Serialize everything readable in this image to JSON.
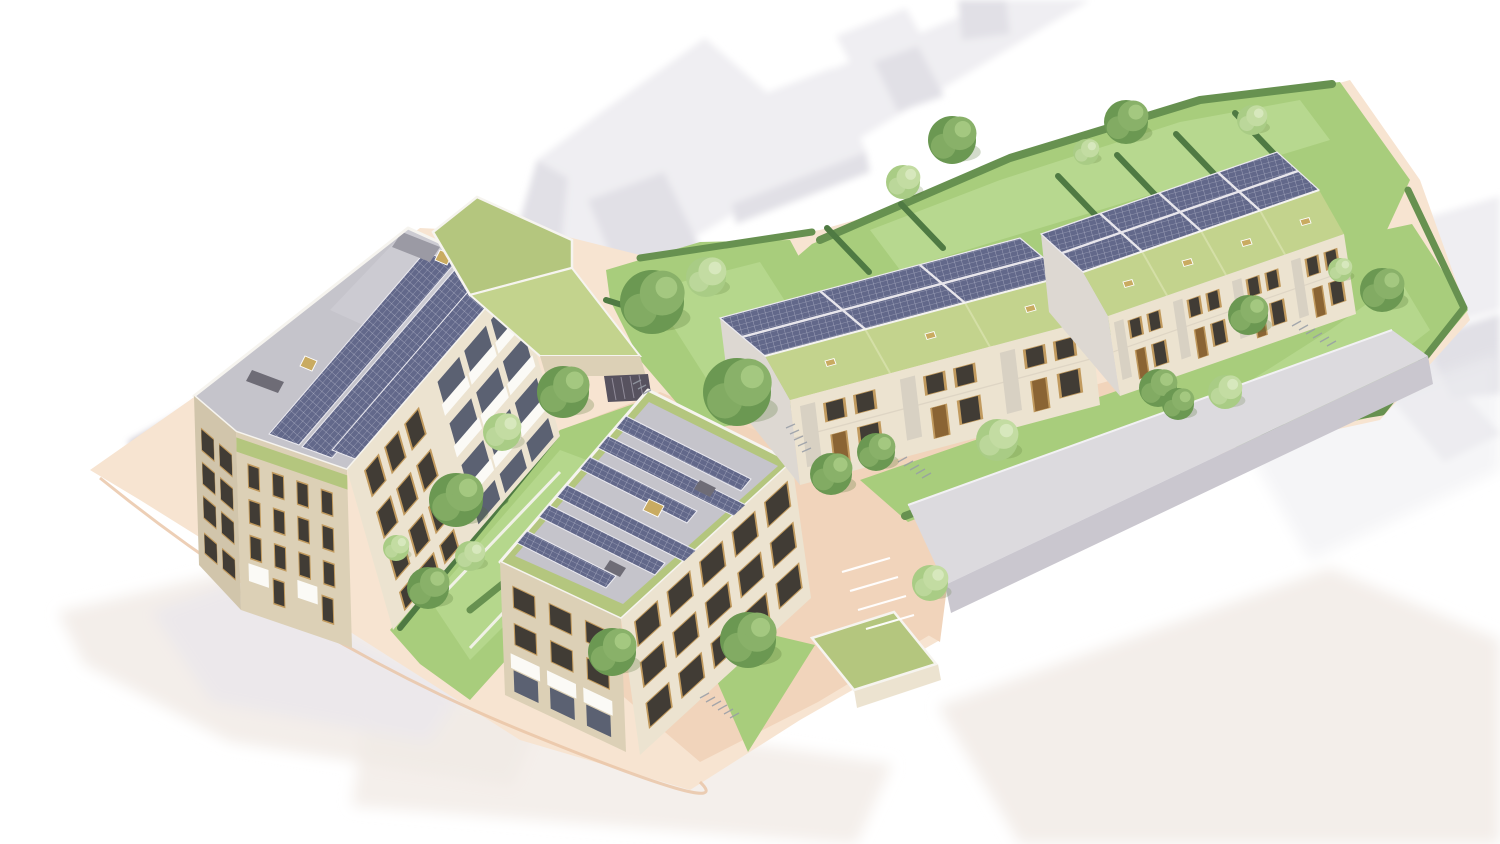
{
  "image": {
    "kind": "aerial-axonometric-architectural-rendering",
    "subject": "Residential infill development with photovoltaic panels and sedum green roofs, surrounding context shown as faded white massing",
    "width_px": 1500,
    "height_px": 844
  },
  "scene": {
    "west_apartment_block": {
      "storeys": 4,
      "roof": "flat grey",
      "solar_strips": 3,
      "rooflights": 2,
      "roof_bulkhead": 1,
      "balcony_bays": 3,
      "balcony_rows": 3,
      "street_awnings": 2,
      "green_roof_terrace": 1
    },
    "central_apartment_block": {
      "storeys": 3,
      "roof": "green-bordered flat",
      "solar_strips": 6,
      "central_rooflight": 1,
      "roof_hatches": 2,
      "sw_awnings": 3
    },
    "terrace_row_west": {
      "houses": 3,
      "roof": "pitched",
      "rear_slope": "photovoltaic",
      "front_slope": "sedum",
      "rooflights": 3
    },
    "terrace_row_east": {
      "houses": 4,
      "roof": "pitched",
      "rear_slope": "photovoltaic",
      "front_slope": "sedum",
      "rooflights": 4
    },
    "rear_gardens": {
      "divider_hedges": 7,
      "boundary": "hedgerow"
    },
    "existing_long_building": 1,
    "green_roof_outbuildings": 2,
    "car_park_ramp_louvres": 1,
    "cycle_stand_clusters": 5,
    "parking_bay_markings": 4,
    "trees": 26
  },
  "palette": {
    "bg": "#ffffff",
    "ghost_top": "#efeef2",
    "ghost_side": "#e1e0e6",
    "ghost_warm": "#f1ebe6",
    "road_shadow": "#8d8294",
    "paving_light": "#f7e4d1",
    "paving_mid": "#f1d4bb",
    "paving_deep": "#e9c3a4",
    "facade_light": "#ece3d0",
    "facade_shade": "#dcd0b6",
    "facade_dark": "#d1c5ab",
    "parapet": "#f6f4ef",
    "roof_grey": "#c5c4cb",
    "roof_sheen": "#d3d2d9",
    "pv": "#62688a",
    "pv_grid": "#e8eaf2",
    "green_roof": "#b4c67e",
    "green_roof_2": "#c3d38d",
    "grass": "#a8cd7c",
    "grass_light": "#bedd97",
    "hedge": "#679150",
    "hedge_dark": "#4f7a43",
    "tree_dark": "#6b9852",
    "tree_mid": "#89b169",
    "tree_light": "#a9cc85",
    "tree_pale": "#c3dca2",
    "window": "#413c35",
    "frame": "#c19a5e",
    "awning": "#fbfaf6",
    "metal": "#979ca6",
    "skylight": "#c9ab61",
    "louvre": "#57525f",
    "marking": "#ffffff"
  }
}
